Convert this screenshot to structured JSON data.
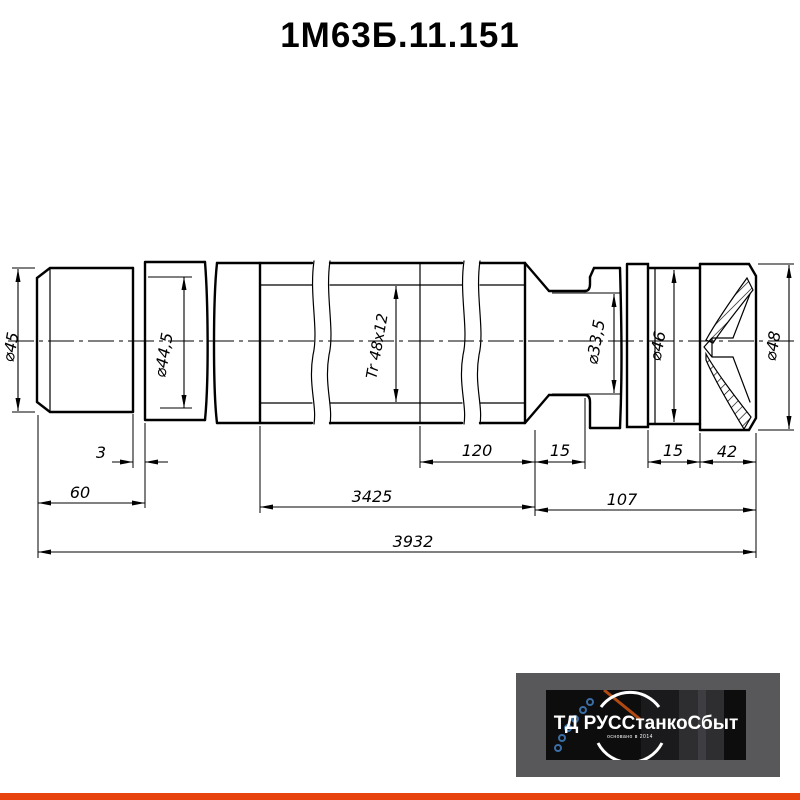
{
  "title": "1М63Б.11.151",
  "drawing": {
    "diameters": {
      "d45": "⌀45",
      "d445": "⌀44,5",
      "thread": "Tr 48x12",
      "d335": "⌀33,5",
      "d46": "⌀46",
      "d48": "⌀48"
    },
    "lengths": {
      "l3": "3",
      "l60": "60",
      "l120": "120",
      "l15a": "15",
      "l15b": "15",
      "l42": "42",
      "l3425": "3425",
      "l107": "107",
      "l3932": "3932"
    }
  },
  "logo": {
    "brand": "ТД РУССтанкоСбыт",
    "subtext": "основано в 2014"
  },
  "colors": {
    "accent_bar": "#E8430C",
    "logo_background": "#58585A",
    "line_color": "#000000"
  }
}
